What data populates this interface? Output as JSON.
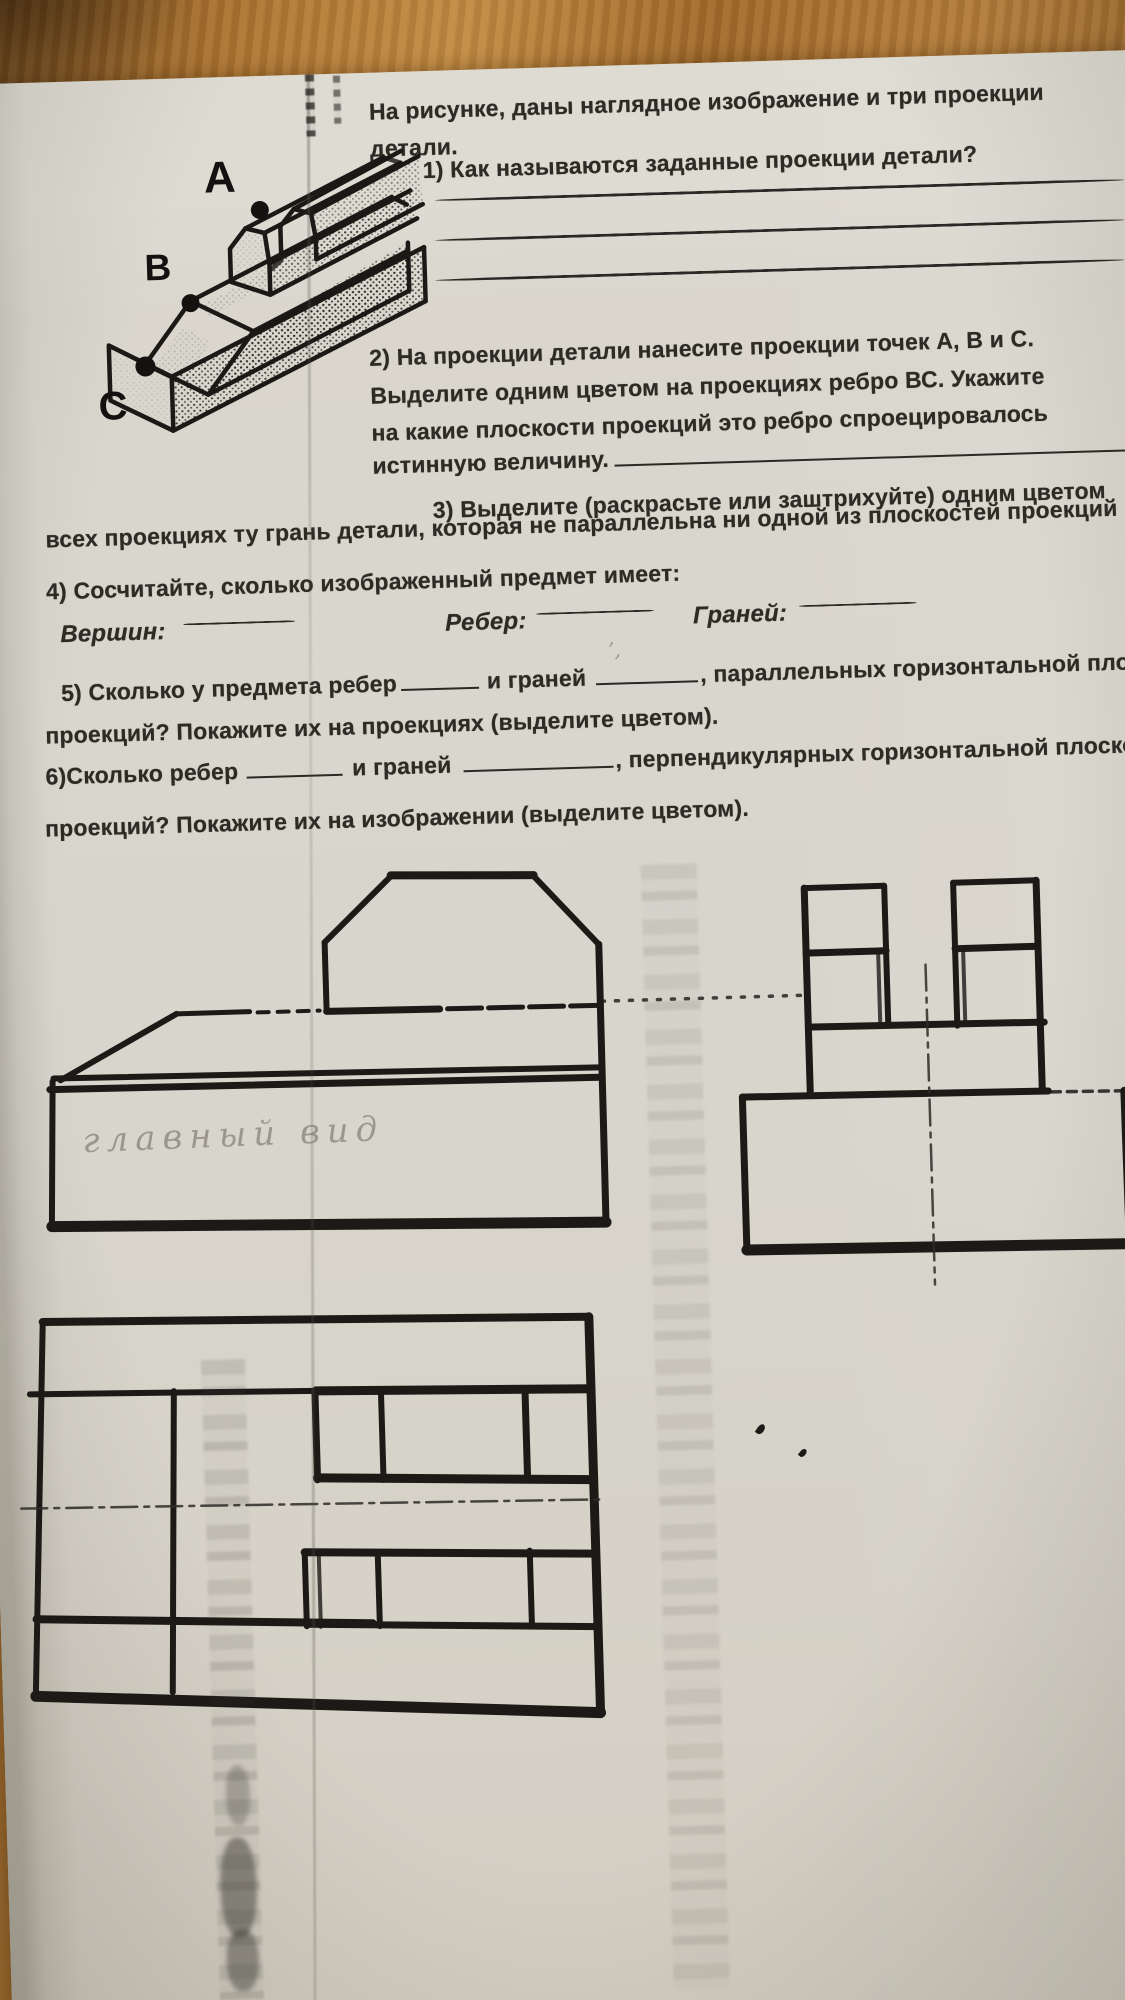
{
  "photo": {
    "desk_color": "#a9712f",
    "paper_color": "#d8d5cc",
    "ink_color": "#2e2b25",
    "pencil_color": "#928d83"
  },
  "worksheet": {
    "intro_line1": "На рисунке,  даны наглядное изображение и три проекции",
    "intro_line2": "детали.",
    "q1": "1)  Как называются заданные проекции детали?",
    "q2_line1": "2) На проекции детали  нанесите проекции точек А, В и С.",
    "q2_line2": "Выделите одним цветом на проекциях ребро ВС. Укажите",
    "q2_line3": "на какие плоскости проекций это ребро спроецировалось",
    "q2_line4_label": "истинную величину.",
    "q3_line1": "3) Выделите (раскрасьте или заштрихуйте) одним цветом",
    "q3_line2": "всех проекциях ту грань детали, которая не параллельна ни одной из плоскостей проекций",
    "q4": "4) Сосчитайте, сколько изображенный предмет  имеет:",
    "q4_fields": {
      "vertices": "Вершин:",
      "edges": "Ребер:",
      "faces": "Граней:"
    },
    "q5_part1": "5) Сколько у предмета ребер",
    "q5_part2": "и граней",
    "q5_part3": ", параллельных горизонтальной плоск",
    "q5_line2": "проекций? Покажите их на проекциях (выделите цветом).",
    "q6_part1": "6)Сколько ребер",
    "q6_part2": "и граней",
    "q6_part3": ", перпендикулярных горизонтальной плоскости",
    "q6_line2": "проекций? Покажите их на изображении (выделите цветом)."
  },
  "isometric_labels": {
    "a": "A",
    "b": "B",
    "c": "C"
  },
  "handwriting": {
    "front_view_caption": "главный вид",
    "stray_mark": "’,"
  }
}
